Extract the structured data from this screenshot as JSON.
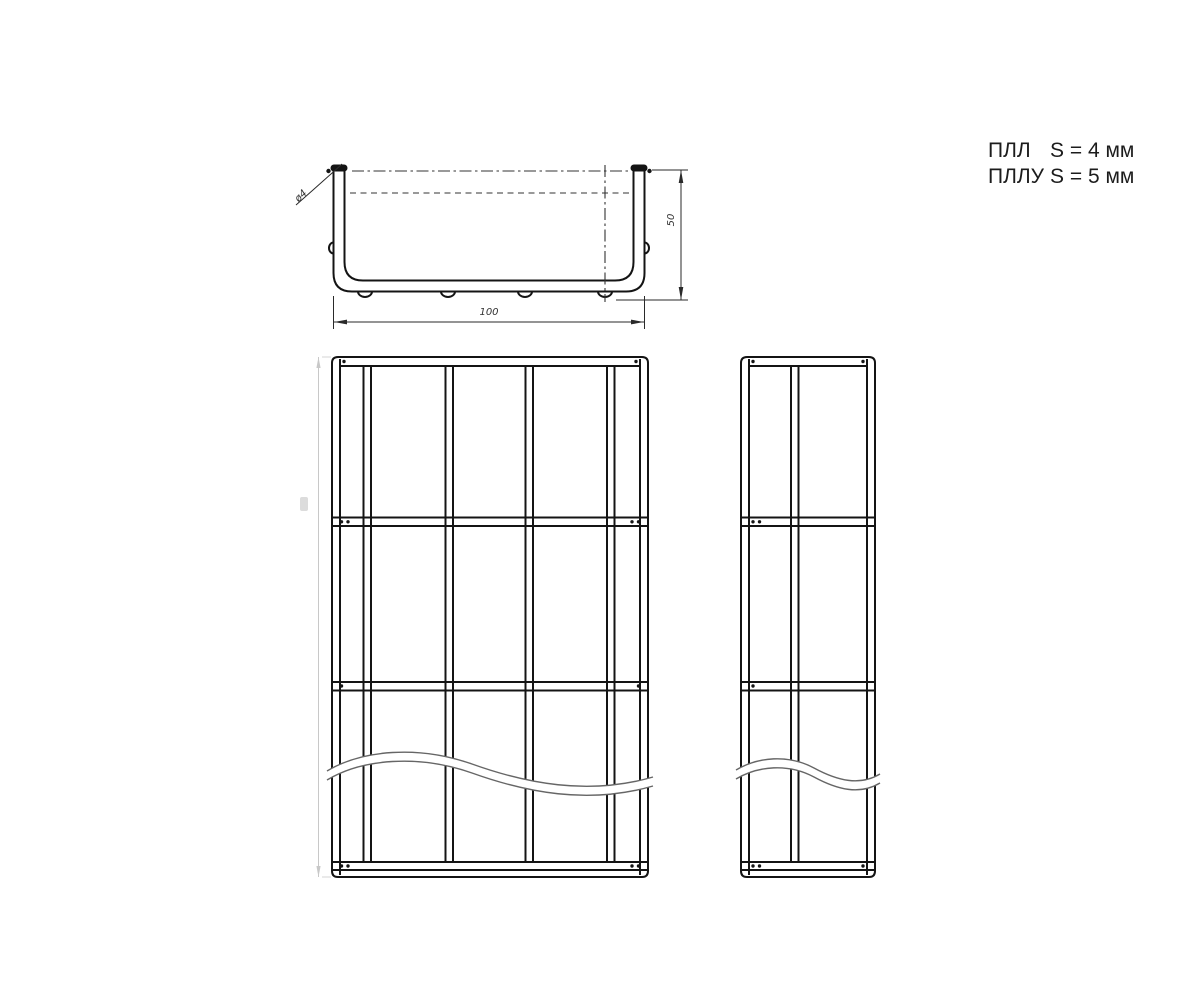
{
  "title_block": {
    "notes": [
      {
        "code": "ПЛЛ",
        "value": "S = 4 мм"
      },
      {
        "code": "ПЛЛУ",
        "value": "S = 5 мм"
      }
    ]
  },
  "section_view": {
    "width": "100",
    "height": "50",
    "wire_diameter": "ø4"
  },
  "colors": {
    "line": "#141414",
    "thin_line": "#2a2a2a",
    "break_line": "#666666",
    "faint_dim": "#c8c8c8",
    "background": "#ffffff"
  }
}
